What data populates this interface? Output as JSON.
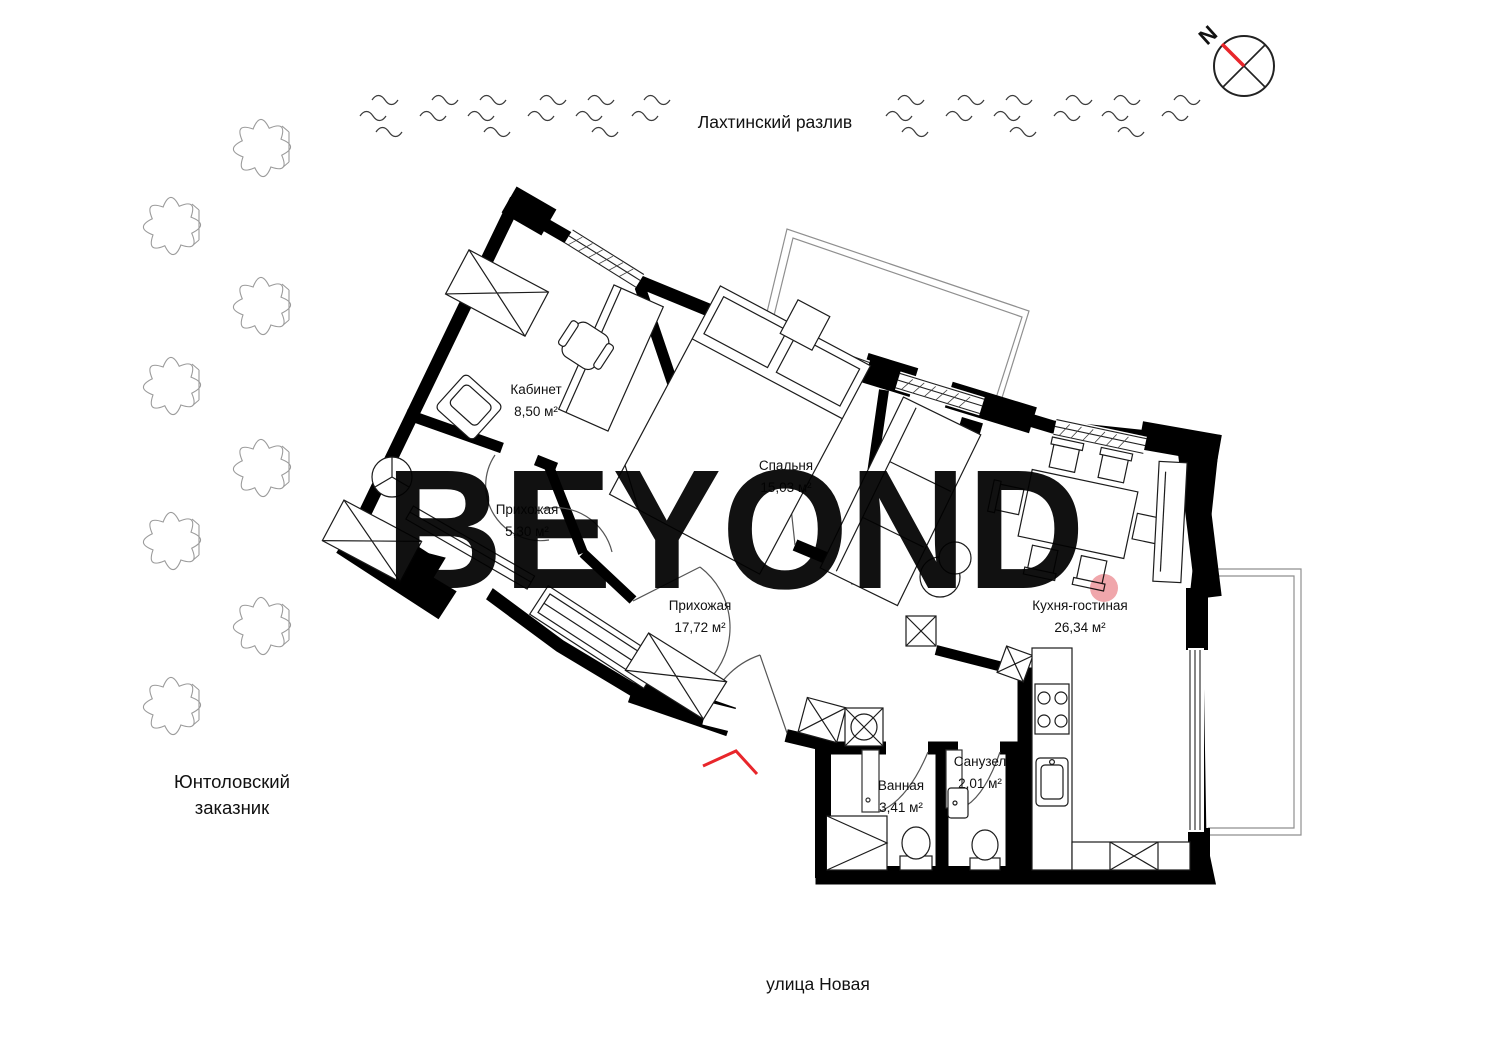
{
  "landmarks": {
    "water": "Лахтинский разлив",
    "reserve_line1": "Юнтоловский",
    "reserve_line2": "заказник",
    "street": "улица Новая"
  },
  "compass": {
    "letter": "N"
  },
  "watermark": {
    "text": "BEYOND",
    "color": "#dcdcdc",
    "dot_color": "#f0a6ab"
  },
  "rooms": [
    {
      "name": "Кабинет",
      "area": "8,50 м²"
    },
    {
      "name": "Спальня",
      "area": "15,03 м²"
    },
    {
      "name": "Прихожая",
      "area": "5,30 м²"
    },
    {
      "name": "Прихожая",
      "area": "17,72 м²"
    },
    {
      "name": "Кухня-гостиная",
      "area": "26,34 м²"
    },
    {
      "name": "Ванная",
      "area": "3,41 м²"
    },
    {
      "name": "Санузел",
      "area": "2,01 м²"
    }
  ],
  "colors": {
    "wall": "#000000",
    "furniture_line": "#1c1c1c",
    "balcony_outline": "#8f8f8f",
    "tree_outline": "#9b9b9b",
    "wave": "#3c3c3c",
    "entrance_mark": "#e8262b",
    "compass_needle": "#e8262b"
  }
}
